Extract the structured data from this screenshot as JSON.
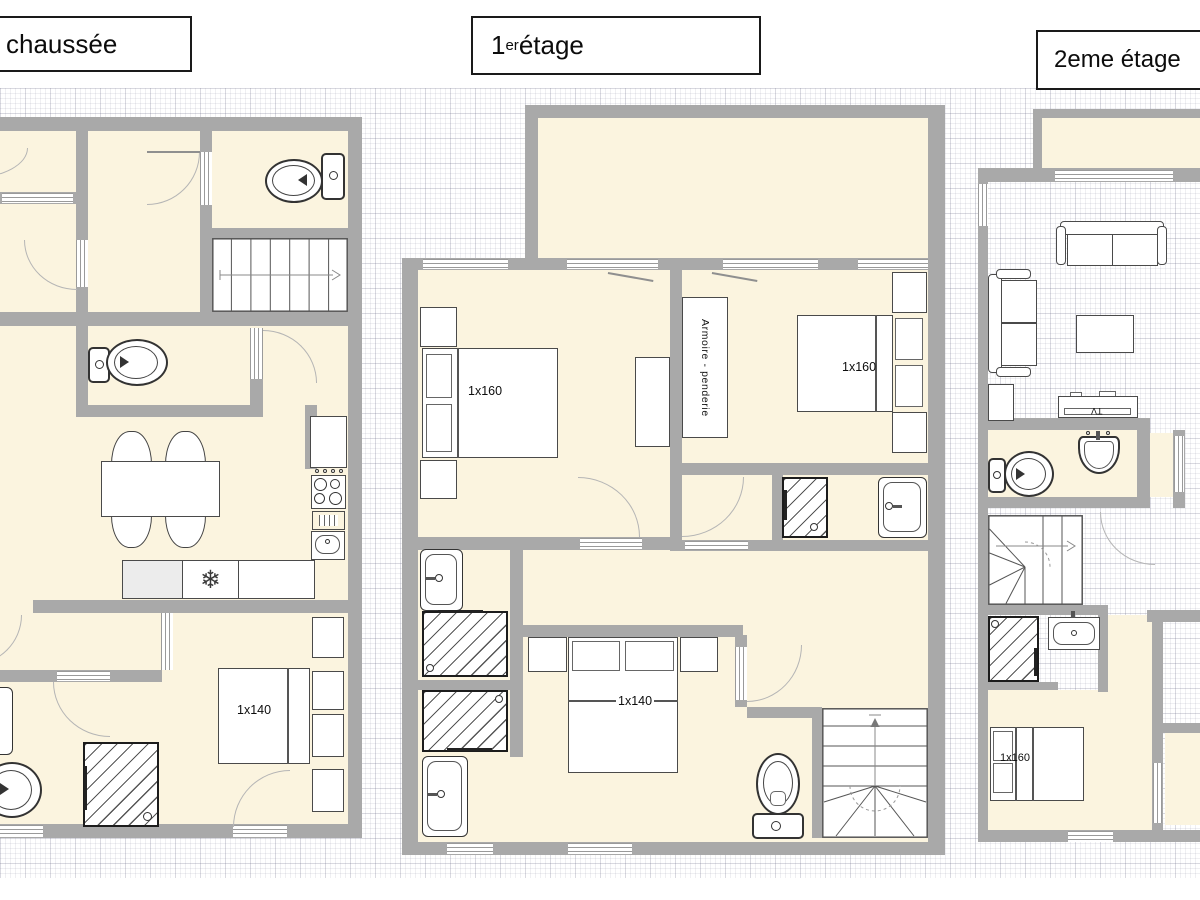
{
  "colors": {
    "wall": "#a9a9a9",
    "floor": "#fbf4df",
    "grid_line": "#b9b9c6",
    "furniture_outline": "#4a4a4a",
    "door_arc": "#b5b5b5"
  },
  "titles": {
    "ground": "chaussée",
    "first": {
      "num": "1",
      "sup": "er",
      "rest": " étage"
    },
    "second": "2eme étage"
  },
  "plans": {
    "ground": {
      "bed_label": "1x140"
    },
    "first": {
      "bed_left_label": "1x160",
      "bed_right_label": "1x160",
      "bed_bottom_label": "1x140",
      "wardrobe_label": "Armoire - penderie"
    },
    "second": {
      "bed_label": "1x160",
      "tv_label": "TV"
    }
  },
  "symbols": {
    "freezer_snowflake": "❄"
  }
}
